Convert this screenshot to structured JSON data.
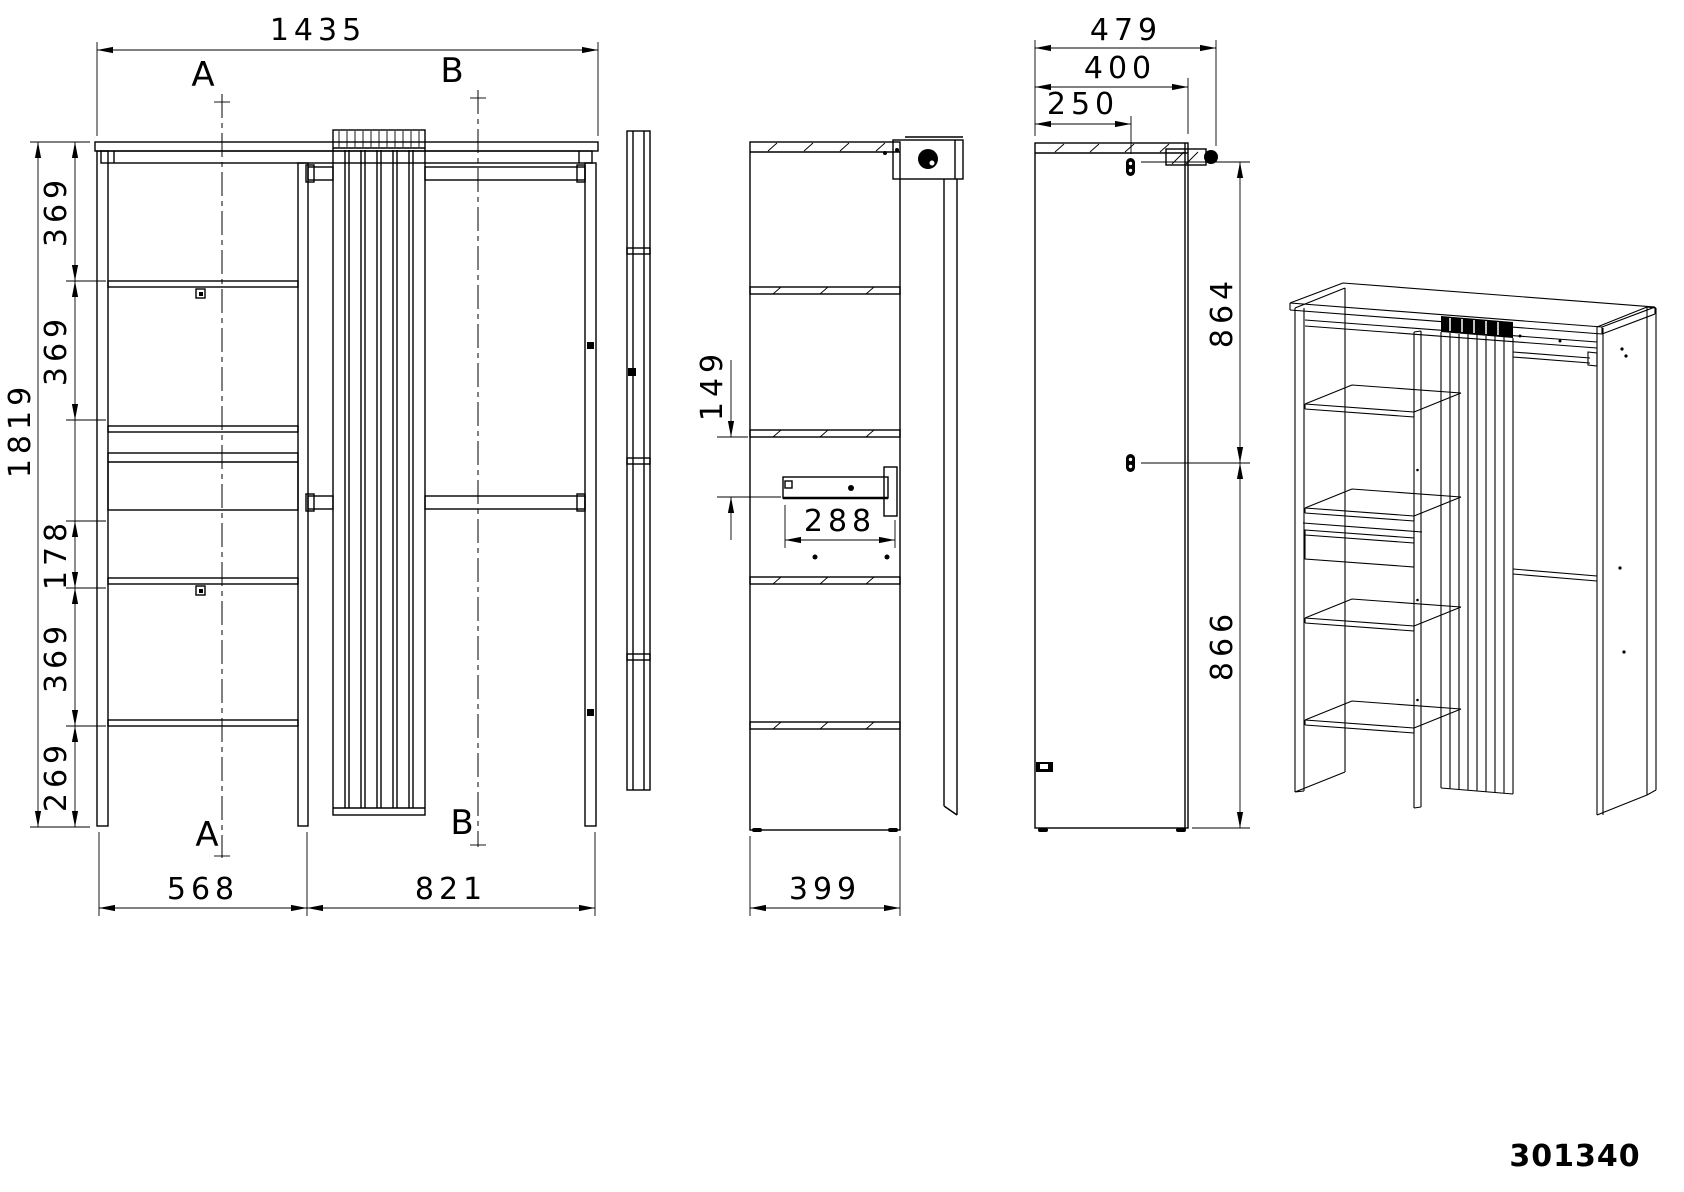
{
  "drawing": {
    "part_number": "301340",
    "section_labels": {
      "a": "A",
      "b": "B"
    },
    "front_view": {
      "total_width": "1435",
      "total_height": "1819",
      "left_heights": [
        "369",
        "369",
        "178",
        "369",
        "269"
      ],
      "bottom_widths": {
        "left": "568",
        "right": "821"
      }
    },
    "side_view": {
      "shelf_to_rail": "149",
      "drawer_depth": "288",
      "panel_depth": "399"
    },
    "panel_view": {
      "total_depth": "479",
      "panel_depth": "400",
      "keyhole_inset": "250",
      "keyhole_spacing_upper": "864",
      "keyhole_spacing_lower": "866"
    }
  }
}
